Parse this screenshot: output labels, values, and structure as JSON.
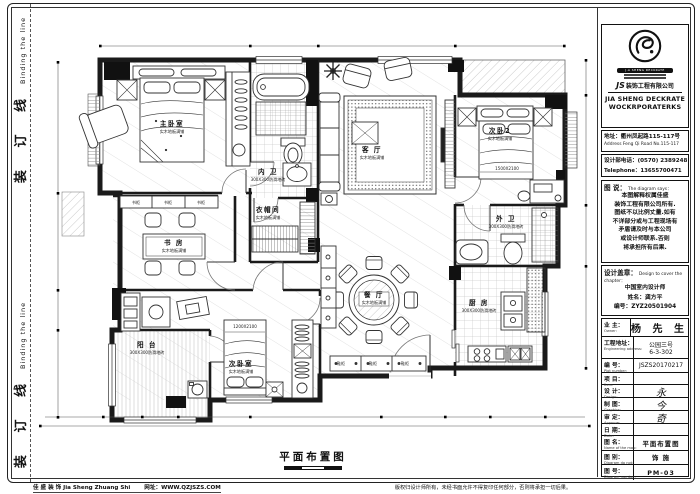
{
  "sheet": {
    "binding_cn": "装 订 线",
    "binding_en": "Binding the line"
  },
  "plan": {
    "title": "平面布置图",
    "rooms": [
      {
        "name": "主卧室",
        "sub": "实木地板满铺",
        "x": 172,
        "y": 126
      },
      {
        "name": "内 卫",
        "sub": "300X300防滑地砖",
        "x": 268,
        "y": 174
      },
      {
        "name": "衣帽间",
        "sub": "实木地板满铺",
        "x": 268,
        "y": 212
      },
      {
        "name": "客 厅",
        "sub": "实木地板满铺",
        "x": 372,
        "y": 152
      },
      {
        "name": "次卧2",
        "sub": "实木地板满铺",
        "x": 500,
        "y": 133
      },
      {
        "name": "外 卫",
        "sub": "300X300防滑地砖",
        "x": 506,
        "y": 221
      },
      {
        "name": "书 房",
        "sub": "实木地板满铺",
        "x": 174,
        "y": 245
      },
      {
        "name": "餐 厅",
        "sub": "实木地板满铺",
        "x": 374,
        "y": 297
      },
      {
        "name": "厨 房",
        "sub": "300X300防滑地砖",
        "x": 479,
        "y": 305
      },
      {
        "name": "阳 台",
        "sub": "300X300防滑地砖",
        "x": 147,
        "y": 347
      },
      {
        "name": "次卧室",
        "sub": "实木地板满铺",
        "x": 241,
        "y": 366
      }
    ],
    "small_labels": [
      {
        "text": "1500X2100",
        "x": 507,
        "y": 170
      },
      {
        "text": "1200X2100",
        "x": 245,
        "y": 328
      },
      {
        "text": "书柜",
        "x": 136,
        "y": 204
      },
      {
        "text": "书柜",
        "x": 168,
        "y": 204
      },
      {
        "text": "书柜",
        "x": 201,
        "y": 204
      },
      {
        "text": "鞋柜",
        "x": 341,
        "y": 365
      },
      {
        "text": "鞋柜",
        "x": 373,
        "y": 365
      },
      {
        "text": "鞋柜",
        "x": 405,
        "y": 365
      }
    ]
  },
  "panel": {
    "logo": {
      "monogram": "JS",
      "badge": "J.A SHENG DECKRATE",
      "company_cn": "装饰工程有限公司",
      "company_en1": "JIA SHENG DECKRATE",
      "company_en2": "WOCKRPORATERKS"
    },
    "address_cn": "地址：衢州凤起路115-117号",
    "address_en": "Address Feng Qi Road No.115-117",
    "phone_cn": "设计部电话：(0570) 2389248",
    "phone_en": "Telephone：13655700471",
    "says": {
      "label_cn": "图 说：",
      "label_en": "The diagram says：",
      "lines": [
        "本图解释权属佳盛",
        "装饰工程有限公司所有.",
        "图纸不以比例丈量.如有",
        "不详部分或与工程现场有",
        "矛盾请及时与本公司",
        "或设计师联系.否则",
        "将承担所有后果."
      ]
    },
    "seal": {
      "label_cn": "设计盖章：",
      "label_en": "Design to cover the chapter：",
      "lines": [
        "中国室内设计师",
        "姓名：龚方平",
        "编号：ZYZ20501904"
      ]
    },
    "rows": [
      {
        "cn": "业 主：",
        "en": "Owner:",
        "value": "杨 先 生",
        "style": "big"
      },
      {
        "cn": "工程地址：",
        "en": "Engineering address:",
        "value": "公园三号",
        "value2": "6-3-302"
      },
      {
        "cn": "编 号：",
        "en": "Plot number:",
        "value": "JSZS20170217"
      },
      {
        "cn": "项 目：",
        "en": "Item:",
        "value": ""
      },
      {
        "cn": "设 计：",
        "en": "Design:",
        "value": "永",
        "style": "sig"
      },
      {
        "cn": "制 图：",
        "en": "Graphics:",
        "value": "今",
        "style": "sig"
      },
      {
        "cn": "审 定：",
        "en": "Approve:",
        "value": "奇",
        "style": "sig"
      },
      {
        "cn": "日 期：",
        "en": "Date:",
        "value": ""
      },
      {
        "cn": "图 名：",
        "en": "Name of the map:",
        "value": "平面布置图",
        "style": "bold"
      },
      {
        "cn": "图 别：",
        "en": "Diagram do not:",
        "value": "饰 施",
        "style": "bold"
      },
      {
        "cn": "图 号：",
        "en": "Diagram number:",
        "value": "PM-03",
        "style": "bold"
      }
    ]
  },
  "footer": {
    "left": "佳 盛 装 饰  Jia Sheng Zhuang Shi",
    "left2": "网址：WWW.QZJSZS.COM",
    "right": "版权归设计师所有，未经书面允许不得复印任何部分，否则将承担一切后果。"
  }
}
